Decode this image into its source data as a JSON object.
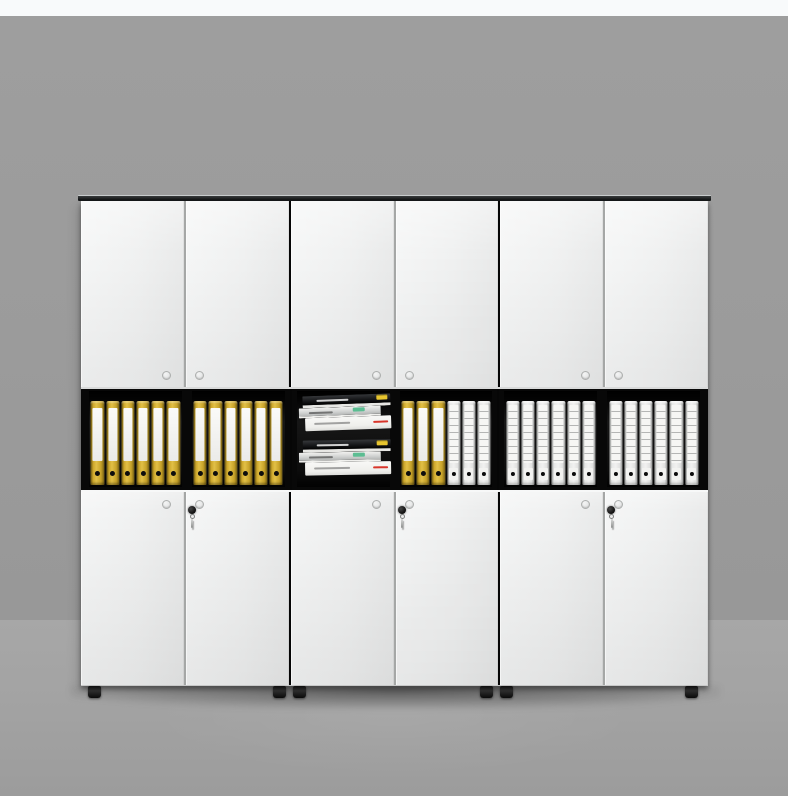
{
  "scene": {
    "description": "Studio product photo of a white six-door office filing cabinet with black top rail, open middle shelf tier holding yellow lever-arch binders, white ruled binders and two stacks of books, lower doors with locks and hanging keys, small black feet, gray wall and floor backdrop",
    "width_px": 788,
    "height_px": 796
  },
  "palette": {
    "page_strip": "#f8fafb",
    "wall": "#9b9b9b",
    "floor": "#a3a3a3",
    "rail_light": "#3a3d3e",
    "rail_dark": "#17191a",
    "door_light": "#f5f6f6",
    "door_mid": "#f0f1f1",
    "door_dark": "#e9eaea",
    "seam": "#a5a7a6",
    "shelf_black": "#080808",
    "comp_black": "#161616",
    "binder_yellow": "#c7a229",
    "binder_yellow_edge": "#6e5910",
    "binder_white": "#f1f1f0",
    "binder_line": "#b4b5b4",
    "label_white": "#fafaf8",
    "dot_black": "#0d0d0d",
    "knob_ring": "#adafae",
    "knob_face": "#dcdddd",
    "lock_black": "#0c0c0c",
    "key_metal": "#8c8e8d",
    "book_black": "#17181a",
    "book_silver": "#cfd1d0",
    "book_white": "#efefec",
    "tag_yellow": "#e7c52f",
    "tag_green": "#5cbd92",
    "tag_red": "#d8352a",
    "foot_black": "#0a0a0a"
  },
  "cabinet": {
    "unit_count": 3,
    "doors_per_unit": 2,
    "tiers": [
      "upper-doors",
      "open-shelf",
      "lower-doors"
    ],
    "units": [
      {
        "upper_doors": [
          {
            "knob": "right"
          },
          {
            "knob": "left"
          }
        ],
        "shelf_compartments": [
          {
            "type": "binders",
            "items": [
              "yellow",
              "yellow",
              "yellow",
              "yellow",
              "yellow",
              "yellow"
            ]
          },
          {
            "type": "binders",
            "items": [
              "yellow",
              "yellow",
              "yellow",
              "yellow",
              "yellow",
              "yellow"
            ]
          }
        ],
        "lower_doors": [
          {
            "knob": "right"
          },
          {
            "knob": "left",
            "lock": true,
            "key": true
          }
        ]
      },
      {
        "upper_doors": [
          {
            "knob": "right"
          },
          {
            "knob": "left"
          }
        ],
        "shelf_compartments": [
          {
            "type": "books",
            "stacks": [
              [
                {
                  "cover": "black",
                  "tag": "yellow"
                },
                {
                  "cover": "silver",
                  "tag": "green"
                },
                {
                  "cover": "white",
                  "tag": "red"
                }
              ],
              [
                {
                  "cover": "black",
                  "tag": "yellow"
                },
                {
                  "cover": "silver",
                  "tag": "green"
                },
                {
                  "cover": "white",
                  "tag": "red"
                }
              ]
            ]
          },
          {
            "type": "binders",
            "items": [
              "yellow",
              "yellow",
              "yellow",
              "white",
              "white",
              "white"
            ]
          }
        ],
        "lower_doors": [
          {
            "knob": "right"
          },
          {
            "knob": "left",
            "lock": true,
            "key": true
          }
        ]
      },
      {
        "upper_doors": [
          {
            "knob": "right"
          },
          {
            "knob": "left"
          }
        ],
        "shelf_compartments": [
          {
            "type": "binders",
            "items": [
              "white",
              "white",
              "white",
              "white",
              "white",
              "white"
            ]
          },
          {
            "type": "binders",
            "items": [
              "white",
              "white",
              "white",
              "white",
              "white",
              "white"
            ]
          }
        ],
        "lower_doors": [
          {
            "knob": "right"
          },
          {
            "knob": "left",
            "lock": true,
            "key": true
          }
        ]
      }
    ],
    "feet_left_px": [
      10,
      195,
      215,
      402,
      422,
      607
    ]
  }
}
